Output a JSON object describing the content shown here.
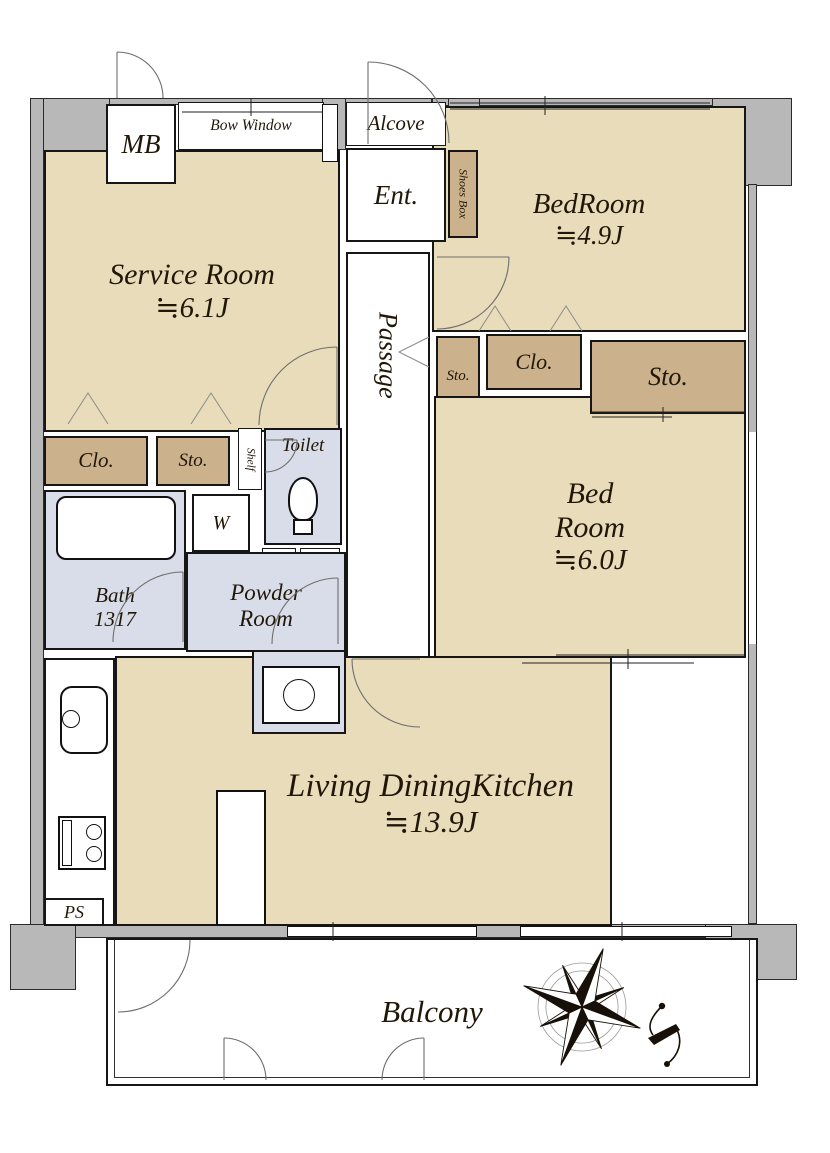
{
  "colors": {
    "room_tan": "#e8dcba",
    "closet_tan": "#ccb18d",
    "wet_area_blue": "#d9dde9",
    "wall_gray": "#b8b8b8",
    "outline_black": "#161616",
    "text": "#211708"
  },
  "rooms": {
    "mb": {
      "label": "MB"
    },
    "bow_window": {
      "label": "Bow Window"
    },
    "alcove": {
      "label": "Alcove"
    },
    "entrance": {
      "label": "Ent."
    },
    "shoes_box": {
      "label": "Shoes Box"
    },
    "bedroom_small": {
      "name": "BedRoom",
      "size": "≒4.9J"
    },
    "service_room": {
      "name": "Service Room",
      "size": "≒6.1J"
    },
    "passage": {
      "label": "Passage"
    },
    "storage_passage": {
      "label": "Sto."
    },
    "closet_bedroom_small": {
      "label": "Clo."
    },
    "storage_bedroom_main": {
      "label": "Sto."
    },
    "bedroom_main": {
      "name_line1": "Bed",
      "name_line2": "Room",
      "size": "≒6.0J"
    },
    "closet_service": {
      "label": "Clo."
    },
    "storage_service": {
      "label": "Sto."
    },
    "shelf": {
      "label": "Shelf"
    },
    "toilet": {
      "label": "Toilet"
    },
    "washer": {
      "label": "W"
    },
    "pipe_space_upper": {
      "label": "PS"
    },
    "linen": {
      "label": "Lin."
    },
    "bath": {
      "name": "Bath",
      "size": "1317"
    },
    "powder_room": {
      "name_line1": "Powder",
      "name_line2": "Room"
    },
    "ldk": {
      "name": "Living DiningKitchen",
      "size": "≒13.9J"
    },
    "pipe_space_lower": {
      "label": "PS"
    },
    "balcony": {
      "label": "Balcony"
    }
  }
}
